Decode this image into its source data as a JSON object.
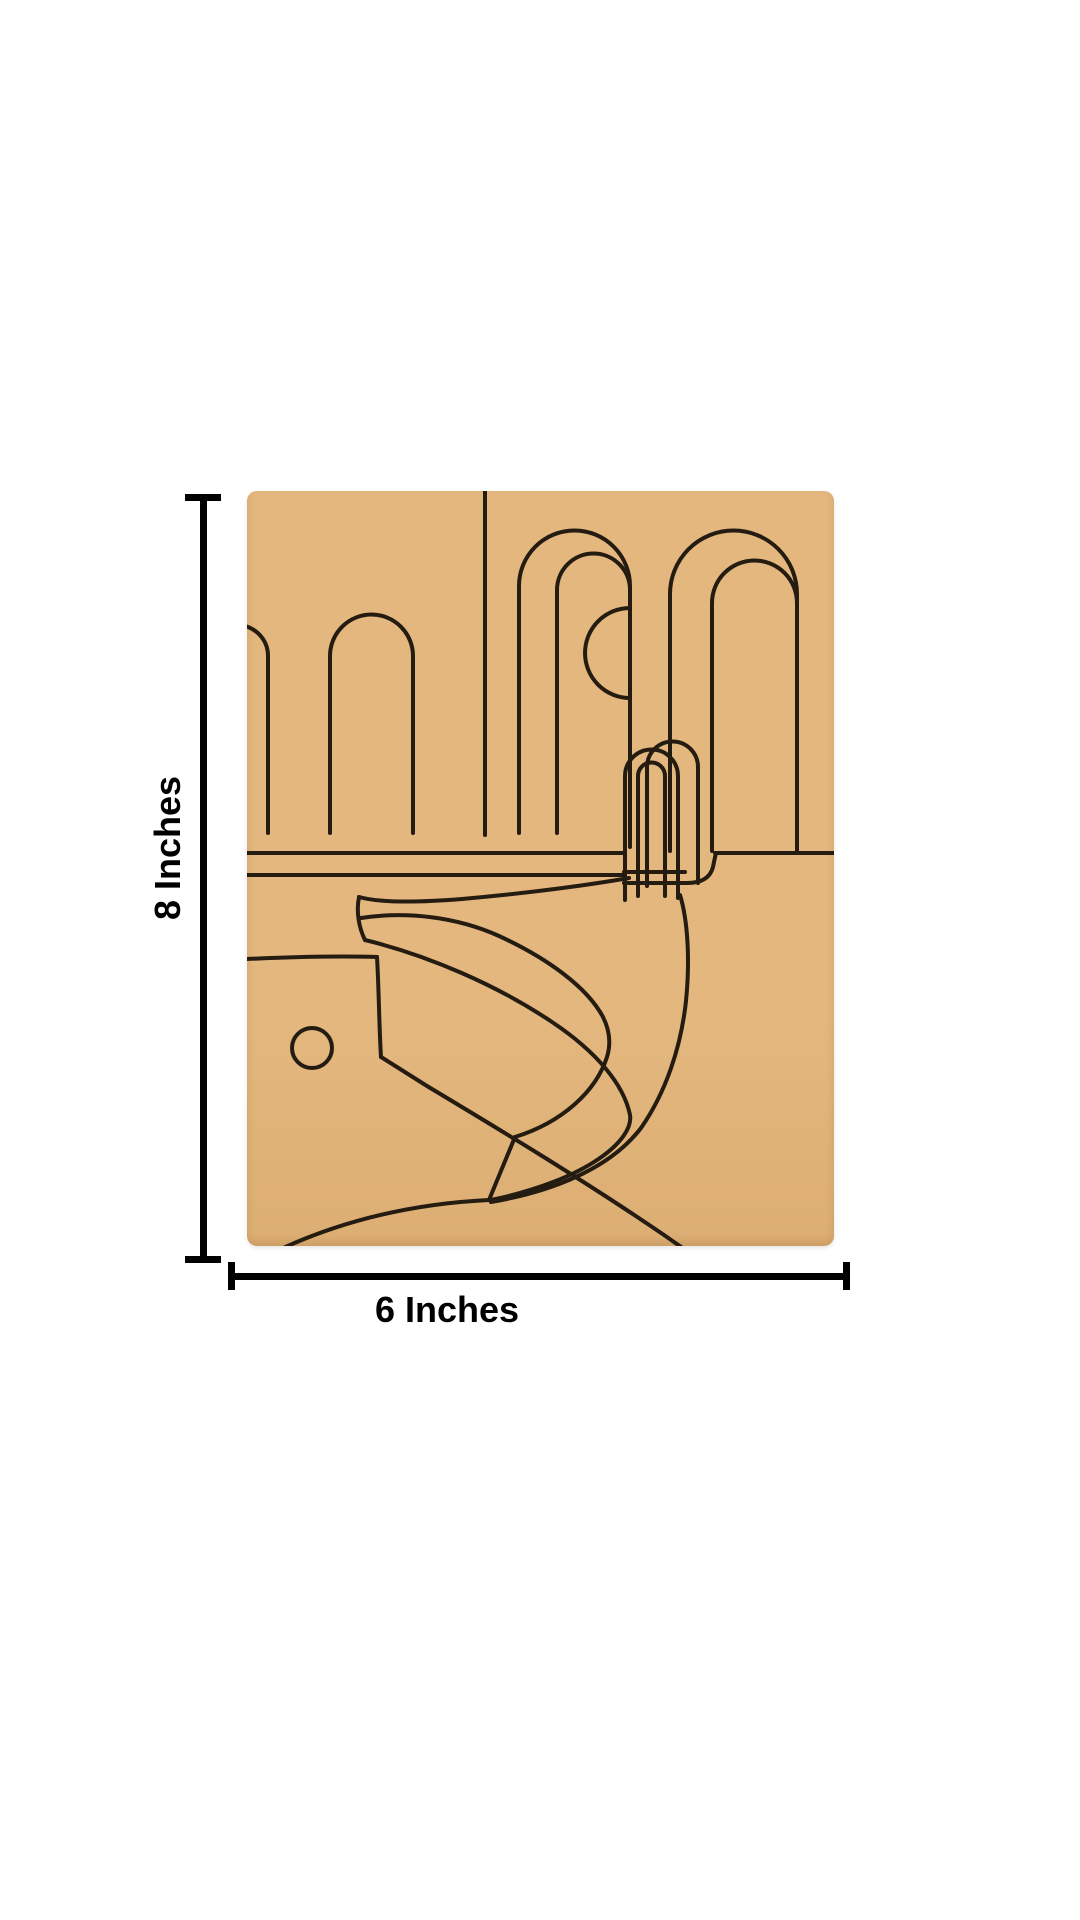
{
  "page": {
    "background": "#ffffff"
  },
  "board": {
    "name": "pre-marked-canvas-board",
    "description": "Tan kraft canvas board pre-marked with art-deco pool scene line art: arched walls, a half sun, a pool ladder and an S-curved slide path",
    "color": "#e3b77e",
    "color_bottom": "#dcae73",
    "line_color": "#241b11"
  },
  "dimensions": {
    "color": "#000000",
    "height_label": "8 Inches",
    "width_label": "6 Inches"
  }
}
